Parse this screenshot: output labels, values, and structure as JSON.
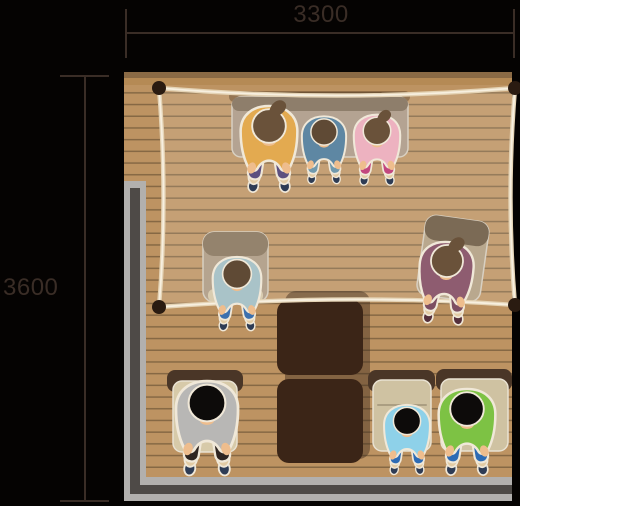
{
  "dimensions": {
    "top": {
      "label": "3300"
    },
    "left": {
      "label": "3600"
    }
  },
  "palette": {
    "bg_black": "#050302",
    "bg_white": "#ffffff",
    "dim": "#3a2d26",
    "floor": "#bd9362",
    "floor_line": "#866844",
    "floor_band_dark": "#8a6a45",
    "floor_band_mid": "#b58a55",
    "wall_light": "#b2b0ae",
    "wall_dark": "#4e4a47"
  },
  "rope": {
    "region_fill": "rgba(255,255,255,0.12)",
    "color_outer": "#e4d3b5",
    "color_inner": "#f7efdf",
    "stake_color": "#2a1b11",
    "stake_r": 7,
    "pillow": "M159,88 Q337,103 515,88 Q506,198 515,305 Q350,293 159,307 Q168,200 159,88 Z",
    "segments": [
      "M159,88 Q337,103 515,88",
      "M515,88 Q506,198 515,305",
      "M159,307 Q350,293 515,305",
      "M159,88 Q168,200 159,307"
    ],
    "stakes": [
      [
        159,
        88
      ],
      [
        515,
        88
      ],
      [
        159,
        307
      ],
      [
        515,
        305
      ]
    ]
  },
  "furniture": [
    {
      "n": "low-table-shadow",
      "x": 229,
      "y": 91,
      "w": 181,
      "h": 11,
      "rx": 5,
      "f": "rgba(56,36,20,0.35)"
    },
    {
      "n": "low-table",
      "x": 232,
      "y": 97,
      "w": 176,
      "h": 60,
      "rx": 9,
      "f": "#b4a392",
      "s": "#d8d0c2"
    },
    {
      "n": "low-table-edge",
      "x": 232,
      "y": 97,
      "w": 176,
      "h": 14,
      "rx": 7,
      "f": "#8e7e6b"
    },
    {
      "n": "floor-chair-left",
      "x": 203,
      "y": 232,
      "w": 65,
      "h": 70,
      "rx": 11,
      "f": "#b5a48f",
      "s": "#d8d0c2"
    },
    {
      "n": "floor-chair-left-back",
      "x": 203,
      "y": 232,
      "w": 65,
      "h": 24,
      "rx": 11,
      "f": "#94836d"
    },
    {
      "n": "floor-chair-left-seat",
      "x": 208,
      "y": 289,
      "w": 55,
      "h": 13,
      "rx": 6,
      "f": "#d9ccb0"
    },
    {
      "n": "floor-chair-right",
      "x": 421,
      "y": 218,
      "w": 64,
      "h": 81,
      "rx": 11,
      "f": "#b9a88e",
      "s": "#d8d0c2",
      "rot": 8,
      "px": 453,
      "py": 258
    },
    {
      "n": "floor-chair-right-back",
      "x": 421,
      "y": 218,
      "w": 64,
      "h": 25,
      "rx": 11,
      "f": "#7b6a55",
      "rot": 8,
      "px": 453,
      "py": 258
    },
    {
      "n": "chest-shadow",
      "x": 285,
      "y": 291,
      "w": 85,
      "h": 168,
      "rx": 11,
      "f": "rgba(60,42,28,0.45)"
    },
    {
      "n": "chest-top",
      "x": 277,
      "y": 300,
      "w": 86,
      "h": 75,
      "rx": 12,
      "f": "#3b2517"
    },
    {
      "n": "chest-bottom",
      "x": 277,
      "y": 379,
      "w": 86,
      "h": 84,
      "rx": 12,
      "f": "#3b2517"
    },
    {
      "n": "desk-a-back",
      "x": 167,
      "y": 370,
      "w": 76,
      "h": 22,
      "rx": 8,
      "f": "#4a3627"
    },
    {
      "n": "desk-a-seat",
      "x": 173,
      "y": 381,
      "w": 64,
      "h": 71,
      "rx": 9,
      "f": "#d7caa9",
      "s": "#e9e2d2"
    },
    {
      "n": "desk-b-back",
      "x": 368,
      "y": 370,
      "w": 67,
      "h": 22,
      "rx": 8,
      "f": "#4a3627"
    },
    {
      "n": "desk-b-seat",
      "x": 373,
      "y": 380,
      "w": 58,
      "h": 71,
      "rx": 9,
      "f": "#cfc2a2",
      "s": "#e9e2d2"
    },
    {
      "n": "desk-b-seam",
      "x": 377,
      "y": 404,
      "w": 50,
      "h": 2,
      "rx": 1,
      "f": "#ab9e82"
    },
    {
      "n": "desk-c-back",
      "x": 436,
      "y": 369,
      "w": 76,
      "h": 22,
      "rx": 8,
      "f": "#4a3627"
    },
    {
      "n": "desk-c-seat",
      "x": 441,
      "y": 379,
      "w": 67,
      "h": 72,
      "rx": 9,
      "f": "#cfc2a2",
      "s": "#e9e2d2"
    }
  ],
  "person_defaults": {
    "skin": "#eebd8d",
    "shoe": "#2e3c55",
    "sole": "#e2cba4",
    "outline": "#f0e8d8"
  },
  "people": [
    {
      "n": "adult-mustard",
      "top": "#e3aa50",
      "pants": "#5c5080",
      "hair": "#6a523a",
      "bun": true,
      "x": 269,
      "y": 126,
      "s": 1.05
    },
    {
      "n": "teen-blue",
      "top": "#5e87a3",
      "pants": "#7099ad",
      "hair": "#5f4a35",
      "bun": false,
      "x": 324,
      "y": 132,
      "s": 0.82
    },
    {
      "n": "teen-pink",
      "top": "#edb2c0",
      "pants": "#c2477f",
      "hair": "#6a523a",
      "bun": true,
      "x": 377,
      "y": 131,
      "s": 0.86
    },
    {
      "n": "teen-teal",
      "top": "#a9c3c8",
      "pants": "#3c70ae",
      "hair": "#5f4a35",
      "bun": false,
      "x": 237,
      "y": 274,
      "s": 0.9
    },
    {
      "n": "adult-mauve",
      "top": "#8e5c70",
      "pants": "#7d4e62",
      "hair": "#6a523a",
      "bun": true,
      "x": 447,
      "y": 261,
      "s": 1.0,
      "rot": 4,
      "shoe": "#55303c"
    },
    {
      "n": "adult-gray",
      "top": "#b8b7b5",
      "pants": "#2e2521",
      "hair": "#0d0b0a",
      "bun": false,
      "x": 207,
      "y": 403,
      "s": 1.15
    },
    {
      "n": "child-skyblue",
      "top": "#8ed1e9",
      "pants": "#2d6bb4",
      "hair": "#0d0b0a",
      "bun": false,
      "x": 407,
      "y": 421,
      "s": 0.85
    },
    {
      "n": "adult-green",
      "top": "#7dc244",
      "pants": "#2d6bb4",
      "hair": "#0d0b0a",
      "bun": false,
      "x": 467,
      "y": 409,
      "s": 1.05
    }
  ]
}
